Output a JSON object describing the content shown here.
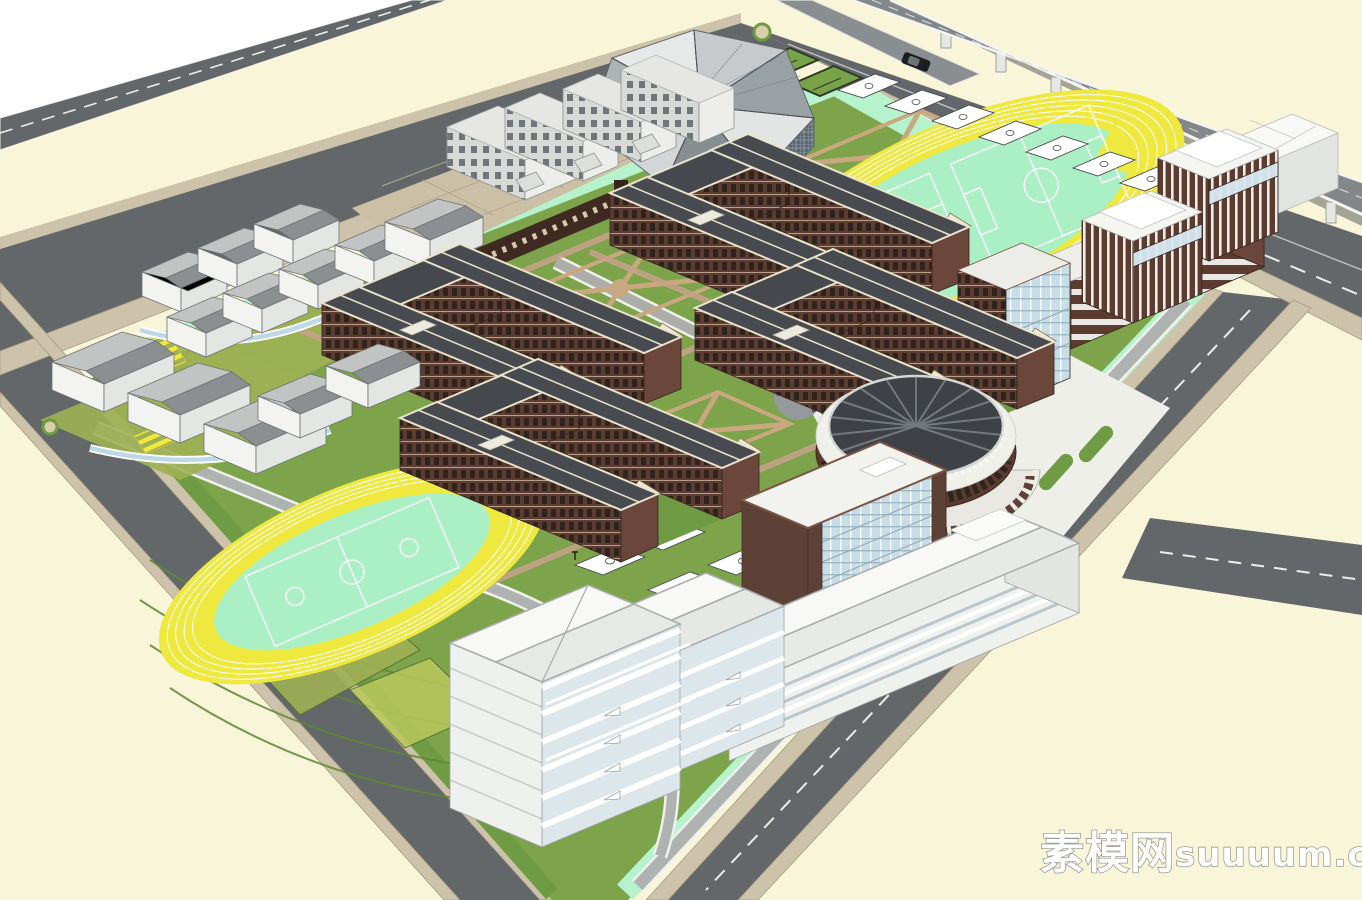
{
  "watermark": {
    "cjk": "素模网",
    "latin": "suuuum.com",
    "full": "素模网suuuum.com"
  },
  "palette": {
    "cream": "#F8F5D8",
    "white": "#FFFFFF",
    "road": "#63676A",
    "roadlight": "#AEB2B0",
    "sidewalk": "#CDC3AA",
    "mint": "#B6F2CC",
    "lawn": "#7DA44B",
    "lawndark": "#6E9B43",
    "olive": "#9FB054",
    "trackyellow": "#EFE93F",
    "infield": "#ABF0C5",
    "brick": "#5C3C31",
    "brickdark": "#43291F",
    "rooftrim": "#E9E2CC",
    "roofdark": "#474A4E",
    "grayroof": "#9FA2A4",
    "glass": "#C7DDE8",
    "glassdark": "#5E6873",
    "steel": "#83878A",
    "plaza": "#EFEFEA",
    "tan": "#CBBFA6",
    "pathbrick": "#C9A28C"
  },
  "scene": {
    "type": "3d-campus-masterplan-render",
    "elements": [
      "perimeter roads",
      "elevated highway viaduct",
      "crystalline gymnasium",
      "dormitory slabs",
      "entrance gate colonnade",
      "four U-shaped brick classroom courtyards",
      "circular auditorium",
      "kindergarten clusters",
      "running track with soccer fields north",
      "running track with courts south",
      "basketball court rows",
      "office mid-rises",
      "terraced white towers",
      "central plaza with swirl",
      "watermark"
    ]
  }
}
